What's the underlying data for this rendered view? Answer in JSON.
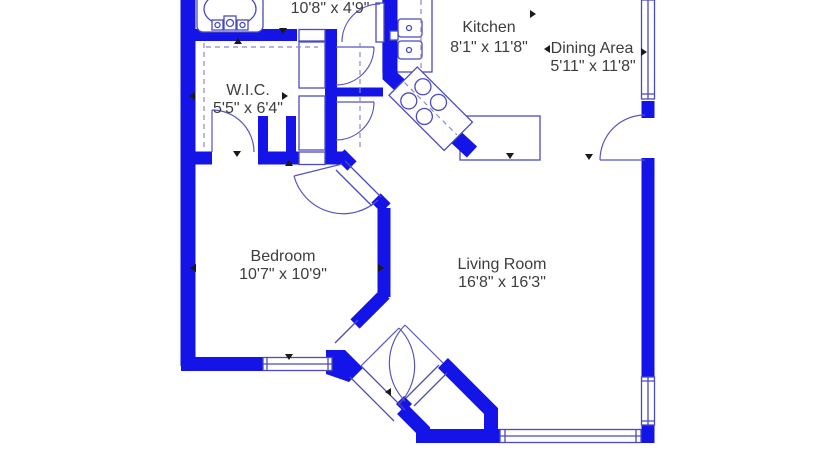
{
  "title": "apartment floor plan",
  "colors": {
    "wall": "#1414e8",
    "line": "#4a4ac0",
    "arc": "#5555bd",
    "dash": "#8888d0",
    "marker": "#1a1a1a",
    "text": "#3d3d3d",
    "bg": "#ffffff"
  },
  "rooms": [
    {
      "id": "hall",
      "name": "",
      "dims": "10'8\" x 4'9\""
    },
    {
      "id": "kitchen",
      "name": "Kitchen",
      "dims": "8'1\" x 11'8\""
    },
    {
      "id": "dining",
      "name": "Dining Area",
      "dims": "5'11\" x 11'8\""
    },
    {
      "id": "wic",
      "name": "W.I.C.",
      "dims": "5'5\" x 6'4\""
    },
    {
      "id": "bedroom",
      "name": "Bedroom",
      "dims": "10'7\" x 10'9\""
    },
    {
      "id": "living",
      "name": "Living Room",
      "dims": "16'8\" x 16'3\""
    }
  ],
  "fixtures": [
    "bathtub",
    "double-basin-sink",
    "cooktop-4-burner",
    "kitchen-counter",
    "closet-shelving"
  ]
}
